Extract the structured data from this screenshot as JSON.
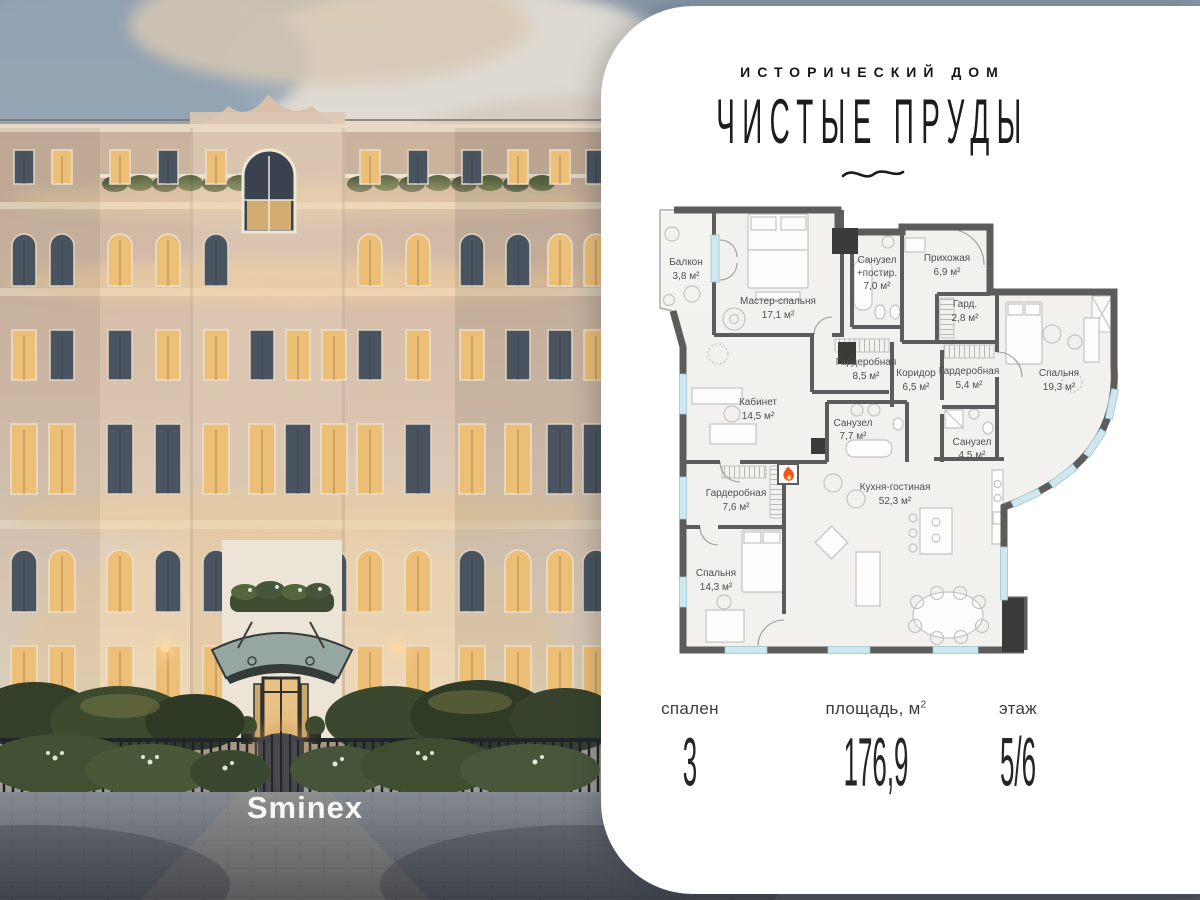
{
  "header": {
    "eyebrow": "ИСТОРИЧЕСКИЙ ДОМ",
    "title": "ЧИСТЫЕ ПРУДЫ"
  },
  "photo": {
    "brand": "Sminex"
  },
  "plan": {
    "rooms": [
      {
        "l1": "Балкон",
        "l2": "3,8 м²"
      },
      {
        "l1": "Мастер-спальня",
        "l2": "17,1 м²"
      },
      {
        "l1": "Санузел",
        "l2": "+постир.",
        "l3": "7,0 м²"
      },
      {
        "l1": "Прихожая",
        "l2": "6,9 м²"
      },
      {
        "l1": "Гард.",
        "l2": "2,8 м²"
      },
      {
        "l1": "Гардеробная",
        "l2": "8,5 м²"
      },
      {
        "l1": "Коридор",
        "l2": "6,5 м²"
      },
      {
        "l1": "Гардеробная",
        "l2": "5,4 м²"
      },
      {
        "l1": "Спальня",
        "l2": "19,3 м²"
      },
      {
        "l1": "Кабинет",
        "l2": "14,5 м²"
      },
      {
        "l1": "Санузел",
        "l2": "7,7 м²"
      },
      {
        "l1": "Санузел",
        "l2": "4,5 м²"
      },
      {
        "l1": "Гардеробная",
        "l2": "7,6 м²"
      },
      {
        "l1": "Спальня",
        "l2": "14,3 м²"
      },
      {
        "l1": "Кухня-гостиная",
        "l2": "52,3 м²"
      }
    ]
  },
  "stats": [
    {
      "label": "спален",
      "sup": "",
      "value": "3"
    },
    {
      "label": "площадь, м",
      "sup": "2",
      "value": "176,9"
    },
    {
      "label": "этаж",
      "sup": "",
      "value": "5/6"
    }
  ],
  "colors": {
    "wall": "#5c5c5c",
    "window": "#cfe8f0",
    "flame": "#f4581f",
    "accent_warm": "#edbe76",
    "panel": "#ffffff"
  }
}
